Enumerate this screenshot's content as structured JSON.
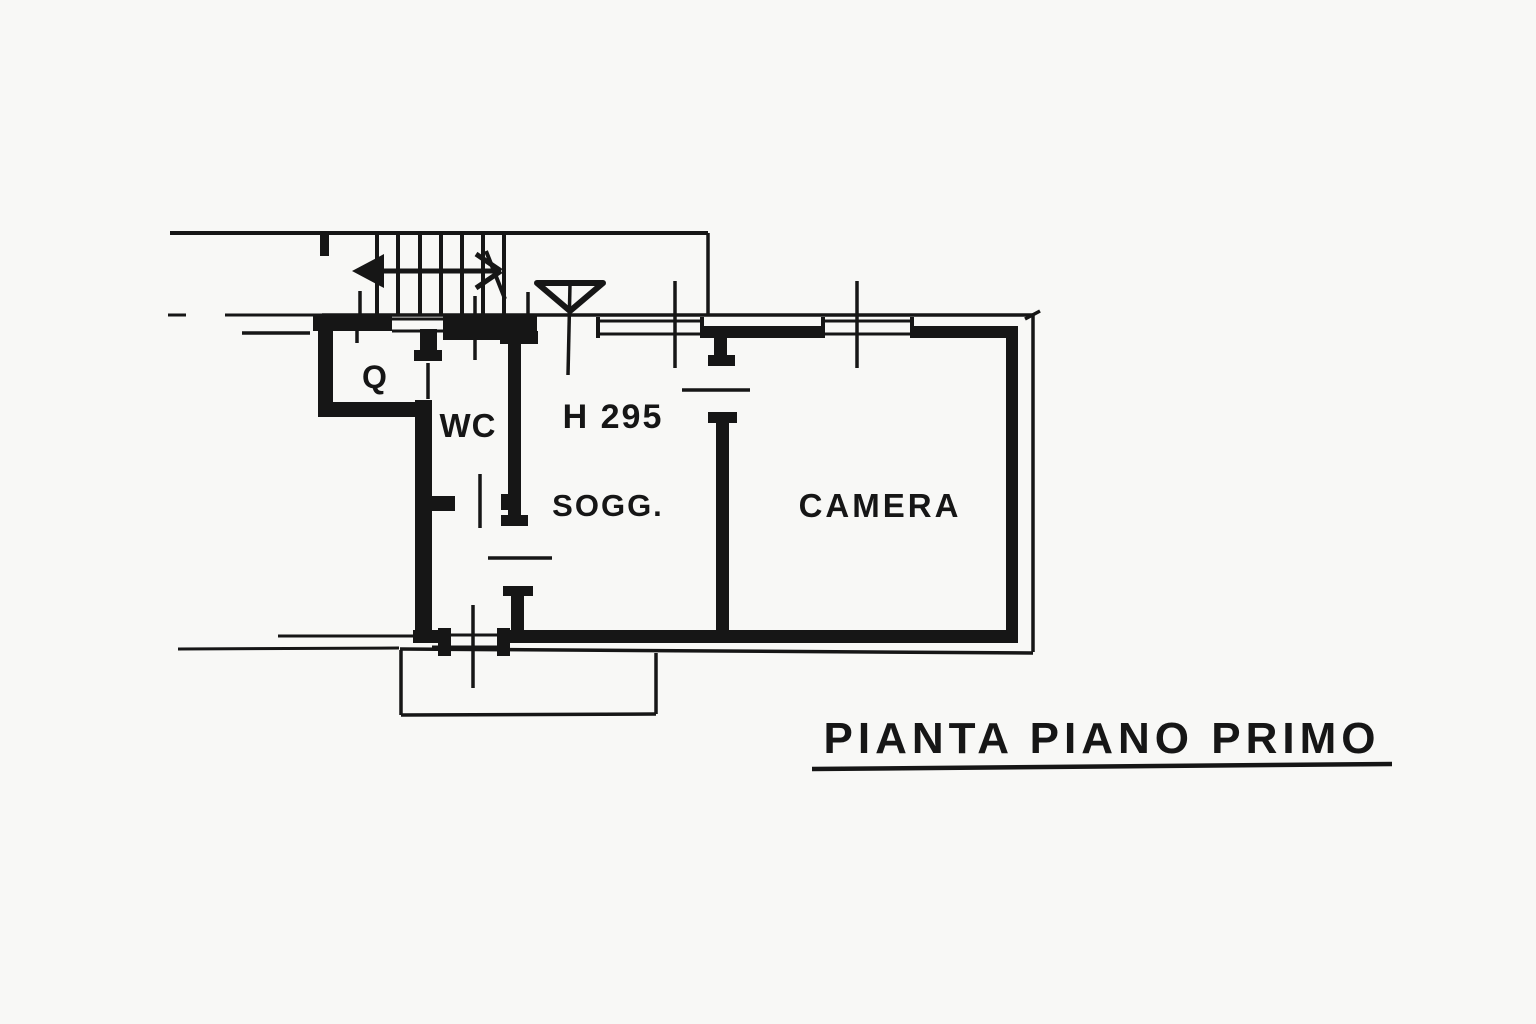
{
  "drawing": {
    "title": "PIANTA PIANO PRIMO",
    "ink_color": "#161616",
    "paper_color": "#f8f8f6",
    "rooms": [
      {
        "id": "q",
        "label": "Q"
      },
      {
        "id": "wc",
        "label": "WC"
      },
      {
        "id": "sogg",
        "label": "SOGG."
      },
      {
        "id": "camera",
        "label": "CAMERA"
      }
    ],
    "annotations": [
      {
        "id": "ceiling-height",
        "label": "H 295"
      }
    ],
    "symbols": [
      "staircase-with-direction-arrow",
      "entrance-triangle-marker",
      "window-cross-ticks",
      "balcony-outline"
    ]
  }
}
